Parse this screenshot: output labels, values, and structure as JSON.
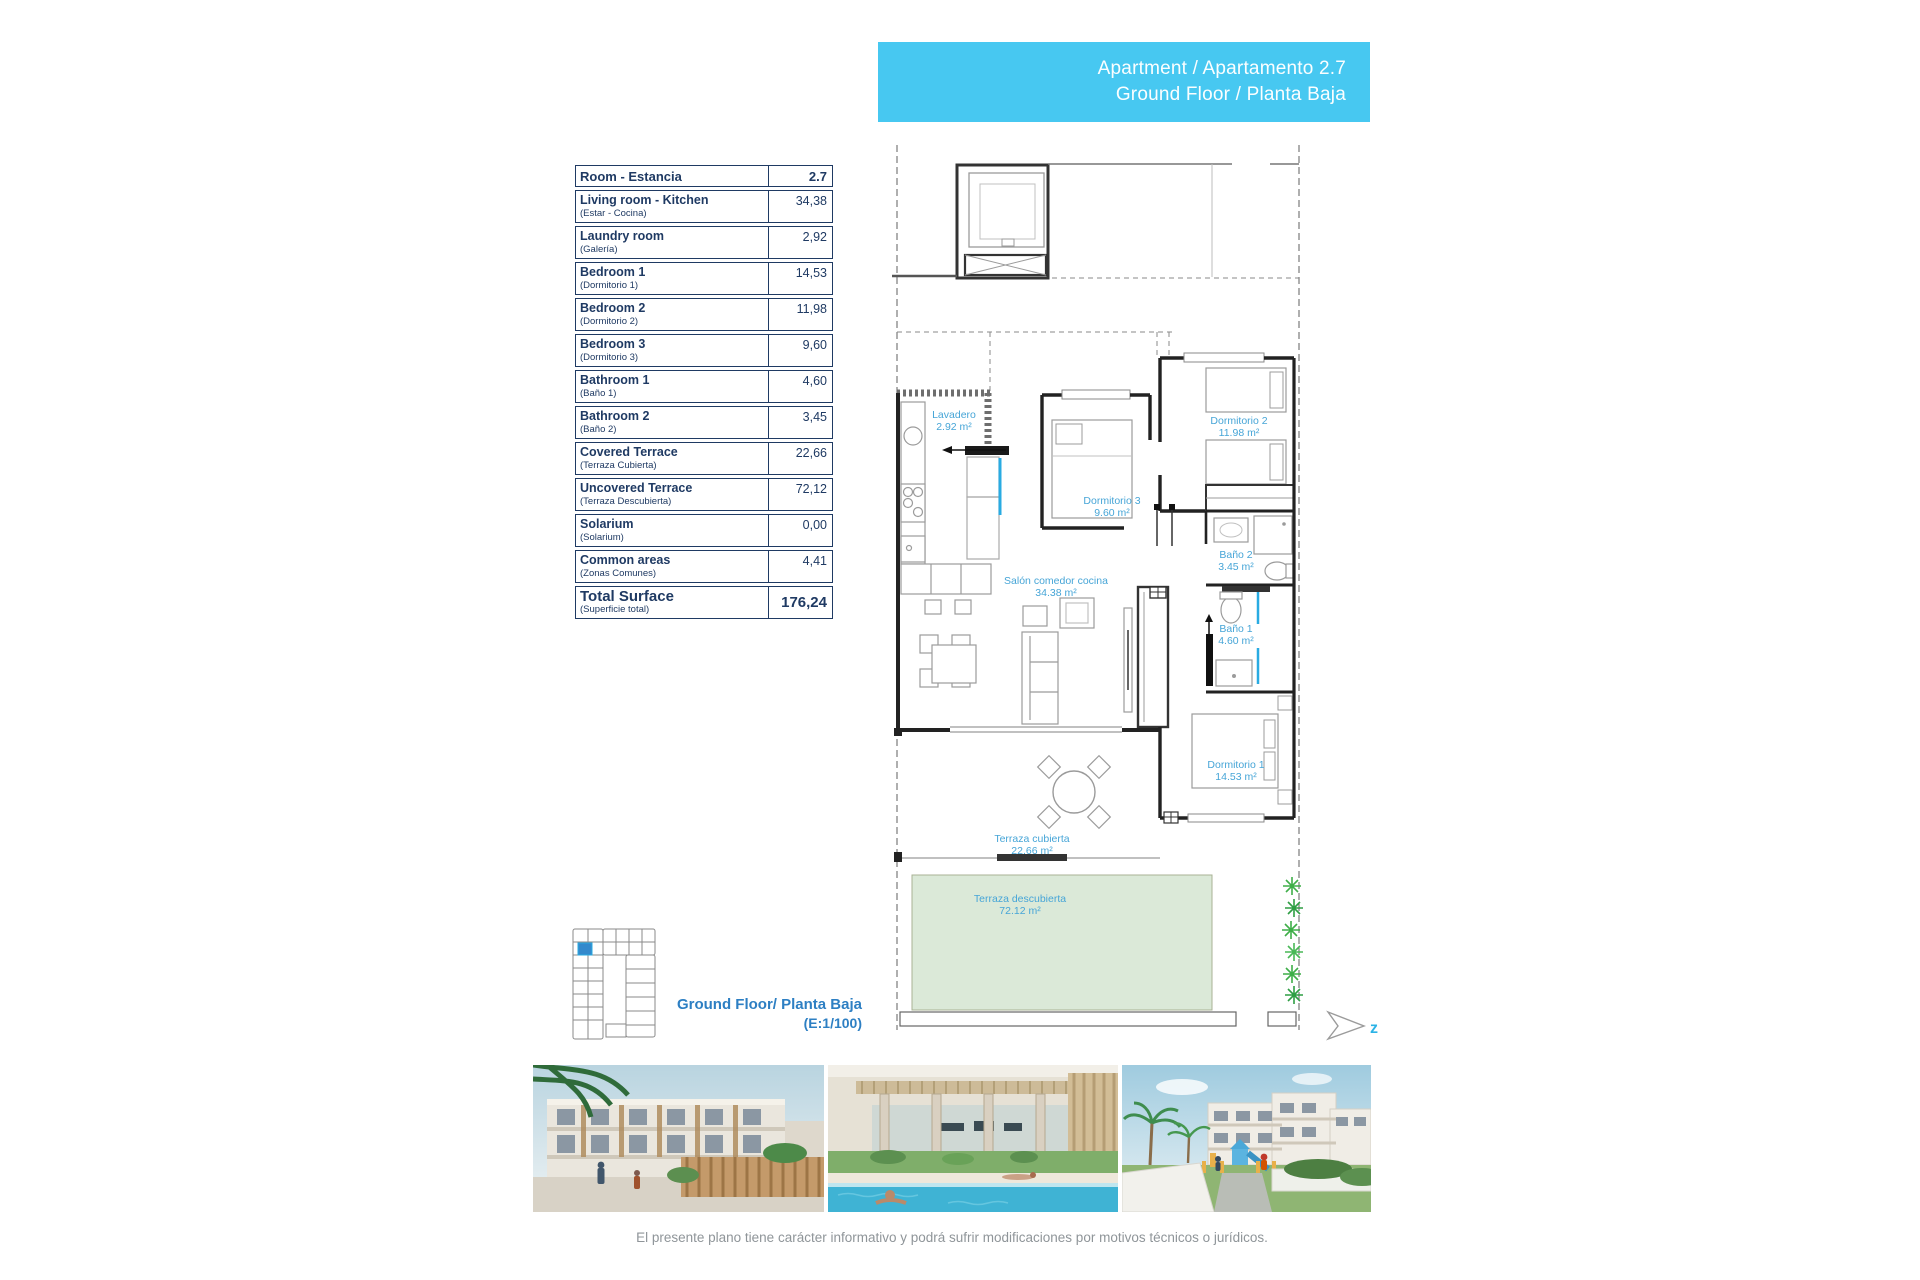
{
  "banner": {
    "line1": "Apartment / Apartamento 2.7",
    "line2": "Ground Floor / Planta Baja"
  },
  "area_table": {
    "header_label": "Room - Estancia",
    "header_value": "2.7",
    "rows": [
      {
        "en": "Living room - Kitchen",
        "es": "(Estar - Cocina)",
        "value": "34,38"
      },
      {
        "en": "Laundry room",
        "es": "(Galería)",
        "value": "2,92"
      },
      {
        "en": "Bedroom 1",
        "es": "(Dormitorio 1)",
        "value": "14,53"
      },
      {
        "en": "Bedroom 2",
        "es": "(Dormitorio 2)",
        "value": "11,98"
      },
      {
        "en": "Bedroom 3",
        "es": "(Dormitorio 3)",
        "value": "9,60"
      },
      {
        "en": "Bathroom 1",
        "es": "(Baño 1)",
        "value": "4,60"
      },
      {
        "en": "Bathroom 2",
        "es": "(Baño 2)",
        "value": "3,45"
      },
      {
        "en": "Covered Terrace",
        "es": "(Terraza Cubierta)",
        "value": "22,66"
      },
      {
        "en": "Uncovered Terrace",
        "es": "(Terraza Descubierta)",
        "value": "72,12"
      },
      {
        "en": "Solarium",
        "es": "(Solarium)",
        "value": "0,00"
      },
      {
        "en": "Common areas",
        "es": "(Zonas Comunes)",
        "value": "4,41"
      }
    ],
    "total": {
      "en": "Total Surface",
      "es": "(Superficie total)",
      "value": "176,24"
    }
  },
  "plan": {
    "labels": {
      "lavadero": {
        "name": "Lavadero",
        "area": "2.92 m²"
      },
      "dorm3": {
        "name": "Dormitorio 3",
        "area": "9.60 m²"
      },
      "dorm2": {
        "name": "Dormitorio 2",
        "area": "11.98 m²"
      },
      "bano2": {
        "name": "Baño 2",
        "area": "3.45 m²"
      },
      "salon": {
        "name": "Salón comedor cocina",
        "area": "34.38 m²"
      },
      "bano1": {
        "name": "Baño 1",
        "area": "4.60 m²"
      },
      "dorm1": {
        "name": "Dormitorio 1",
        "area": "14.53 m²"
      },
      "terraza_cubierta": {
        "name": "Terraza cubierta",
        "area": "22.66 m²"
      },
      "terraza_descubierta": {
        "name": "Terraza descubierta",
        "area": "72.12 m²"
      }
    },
    "north_letter": "z"
  },
  "keyplan": {
    "caption_line1": "Ground Floor/ Planta Baja",
    "caption_line2": "(E:1/100)"
  },
  "disclaimer": "El presente plano tiene carácter informativo y podrá sufrir modificaciones por motivos técnicos o jurídicos.",
  "colors": {
    "banner": "#47c8f1",
    "table_ink": "#1f3a63",
    "plan_label": "#46a5d7",
    "keyplan_caption": "#2d7fc3",
    "terrace_green": "#dbe9d8",
    "accent_cyan": "#29abe2",
    "plant_green": "#3fae49",
    "disclaimer_gray": "#8f9599"
  }
}
